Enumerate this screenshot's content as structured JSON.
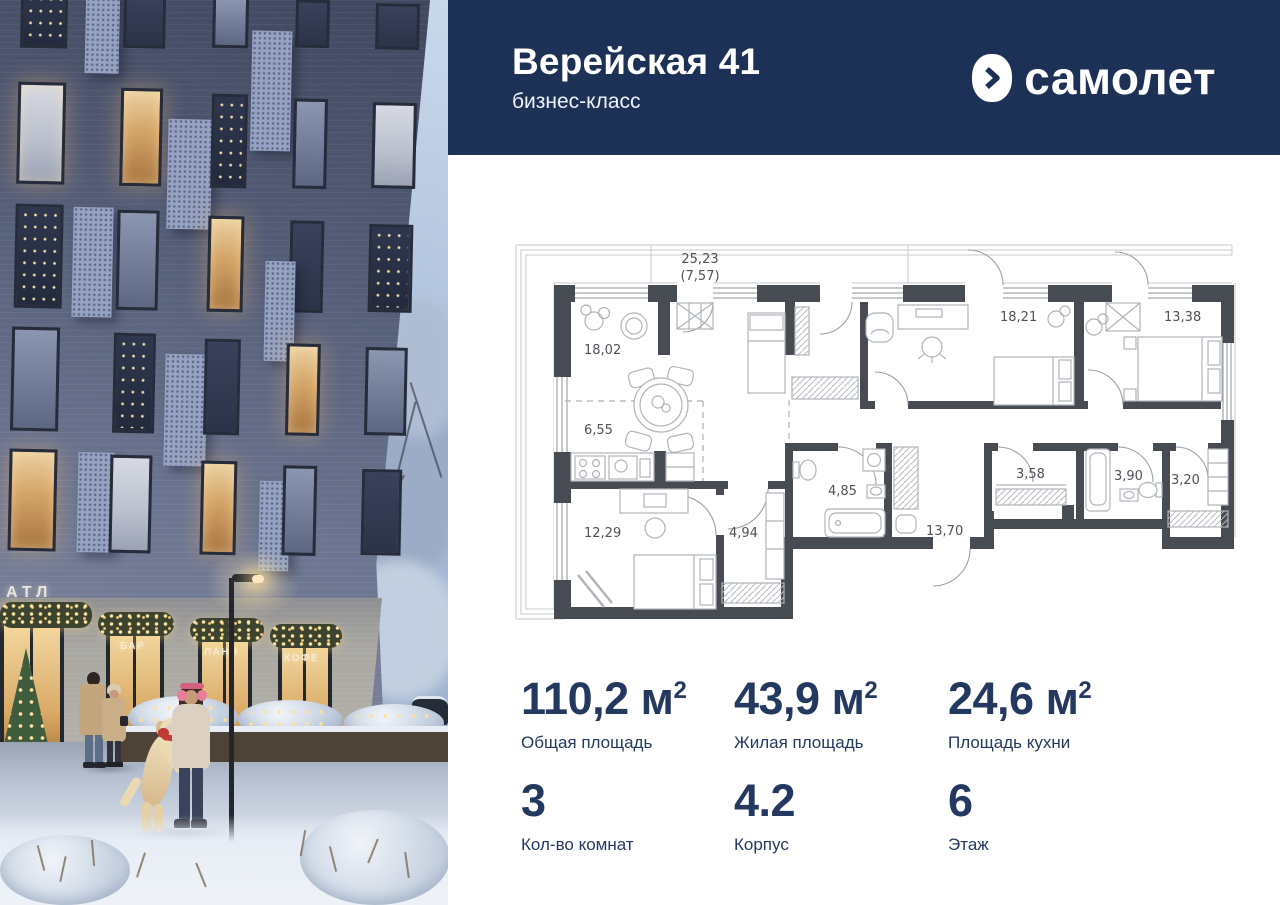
{
  "header": {
    "title": "Верейская 41",
    "subtitle": "бизнес-класс",
    "brand": "самолет"
  },
  "photo": {
    "building_sign": "АТЛ",
    "storefront_signs": {
      "bar": "БАР",
      "lunch": "ЛАНЧ",
      "coffee": "КОФЕ"
    }
  },
  "floorplan": {
    "terrace_area": "25,23",
    "terrace_area_secondary": "(7,57)",
    "rooms": {
      "living": "18,02",
      "kitchen": "6,55",
      "bedroom1": "12,29",
      "hall": "4,94",
      "bathroom1": "4,85",
      "corridor": "13,70",
      "bedroom2": "18,21",
      "bedroom3": "13,38",
      "wardrobe": "3,58",
      "bathroom2": "3,90",
      "closet": "3,20"
    }
  },
  "stats": {
    "row1": [
      {
        "value": "110,2",
        "unit": "м",
        "sup": "2",
        "label": "Общая площадь"
      },
      {
        "value": "43,9",
        "unit": "м",
        "sup": "2",
        "label": "Жилая площадь"
      },
      {
        "value": "24,6",
        "unit": "м",
        "sup": "2",
        "label": "Площадь кухни"
      }
    ],
    "row2": [
      {
        "value": "3",
        "label": "Кол-во комнат"
      },
      {
        "value": "4.2",
        "label": "Корпус"
      },
      {
        "value": "6",
        "label": "Этаж"
      }
    ]
  },
  "colors": {
    "header_bg": "#1d3156",
    "stat_text": "#24395f",
    "plan_wall": "#474c52",
    "window_glow": "#e8b066"
  }
}
